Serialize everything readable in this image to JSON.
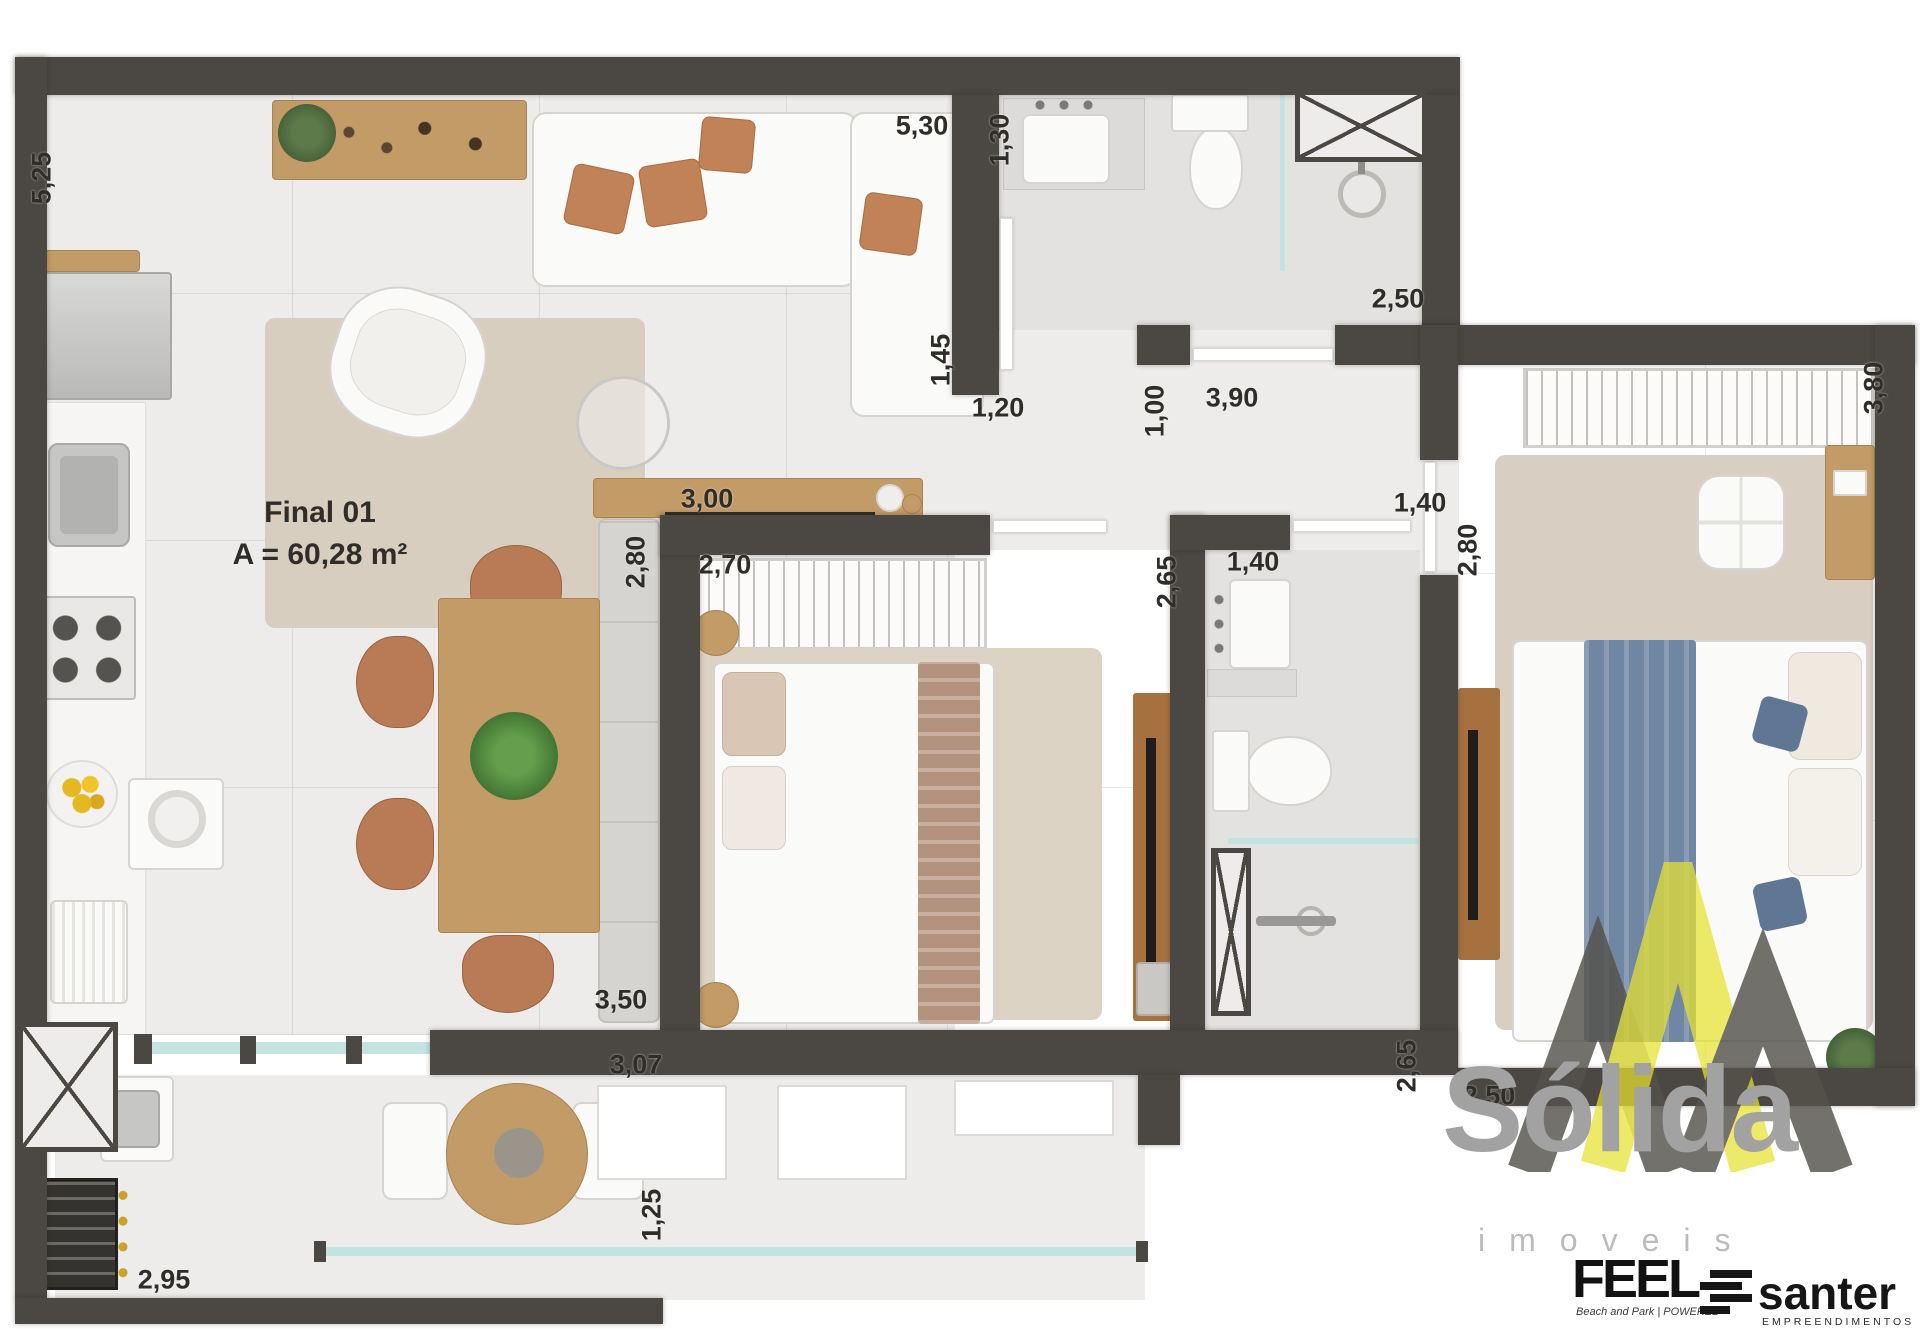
{
  "unit": {
    "name": "Final 01",
    "area_label": "A = 60,28 m²"
  },
  "dimensions": [
    {
      "value": "5,25",
      "cx": 42,
      "cy": 178,
      "vertical": true
    },
    {
      "value": "5,30",
      "cx": 922,
      "cy": 126,
      "vertical": false
    },
    {
      "value": "1,30",
      "cx": 1000,
      "cy": 140,
      "vertical": true
    },
    {
      "value": "1,45",
      "cx": 941,
      "cy": 360,
      "vertical": true
    },
    {
      "value": "1,20",
      "cx": 998,
      "cy": 408,
      "vertical": false
    },
    {
      "value": "2,50",
      "cx": 1398,
      "cy": 299,
      "vertical": false
    },
    {
      "value": "1,00",
      "cx": 1155,
      "cy": 411,
      "vertical": true
    },
    {
      "value": "3,90",
      "cx": 1232,
      "cy": 398,
      "vertical": false
    },
    {
      "value": "3,80",
      "cx": 1874,
      "cy": 388,
      "vertical": true
    },
    {
      "value": "1,40",
      "cx": 1420,
      "cy": 503,
      "vertical": false
    },
    {
      "value": "2,80",
      "cx": 1468,
      "cy": 550,
      "vertical": true
    },
    {
      "value": "3,00",
      "cx": 707,
      "cy": 499,
      "vertical": false
    },
    {
      "value": "2,80",
      "cx": 636,
      "cy": 562,
      "vertical": true
    },
    {
      "value": "2,70",
      "cx": 725,
      "cy": 565,
      "vertical": false
    },
    {
      "value": "2,65",
      "cx": 1167,
      "cy": 582,
      "vertical": true
    },
    {
      "value": "1,40",
      "cx": 1253,
      "cy": 562,
      "vertical": false
    },
    {
      "value": "3,50",
      "cx": 621,
      "cy": 1000,
      "vertical": false
    },
    {
      "value": "3,07",
      "cx": 636,
      "cy": 1065,
      "vertical": false
    },
    {
      "value": "2,65",
      "cx": 1407,
      "cy": 1066,
      "vertical": true
    },
    {
      "value": "2,50",
      "cx": 1489,
      "cy": 1096,
      "vertical": false
    },
    {
      "value": "2,95",
      "cx": 164,
      "cy": 1280,
      "vertical": false
    },
    {
      "value": "1,25",
      "cx": 652,
      "cy": 1215,
      "vertical": true
    }
  ],
  "logos": {
    "solida": {
      "title": "Sólida",
      "subtitle": "imoveis"
    },
    "feel": {
      "title": "FEEL",
      "tagline": "Beach and Park | POWERED"
    },
    "santer": {
      "title": "santer",
      "subtitle": "EMPREENDIMENTOS"
    }
  },
  "colors": {
    "wall": "#4b4742",
    "floor": "#edecea",
    "watermark_yellow": "#e7e32f",
    "watermark_gray": "#55524c",
    "logo_gray": "#a2a2a2"
  }
}
